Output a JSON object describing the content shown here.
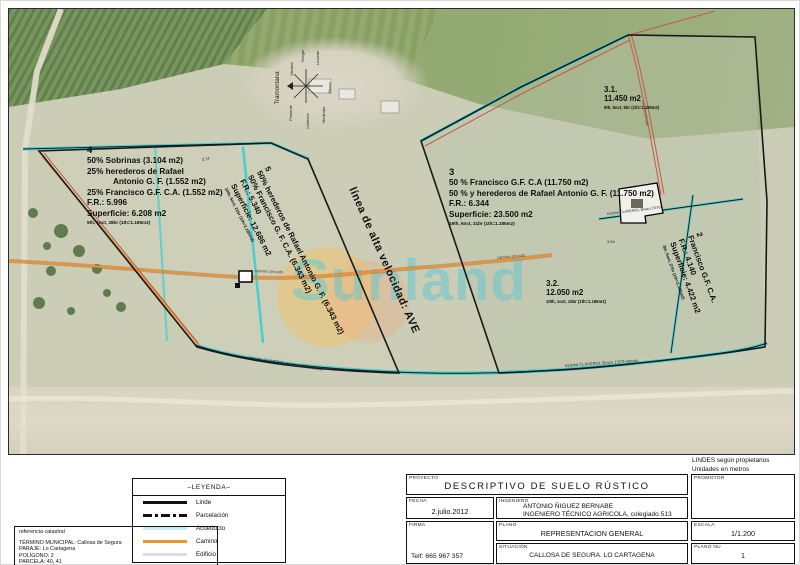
{
  "watermark": {
    "text": "Sunland"
  },
  "compass": {
    "labels": [
      "Tramontana",
      "Mestral",
      "Gregal",
      "Levante",
      "Siroco",
      "Mediodía",
      "Lebeche",
      "Poniente"
    ]
  },
  "map": {
    "parcels": {
      "p4": {
        "id": "4",
        "lines": [
          "50% Sobrinas (3.104 m2)",
          "25% herederos de Rafael",
          "Antonio G. F. (1.552 m2)",
          "25% Francisco G.F. C.A. (1.552 m2)",
          "F.R.: 5.996",
          "Superficie: 6.208 m2"
        ],
        "units": "5th, 1oct, 28br (1th=1.185m2)"
      },
      "p5": {
        "id": "5",
        "lines": [
          "50% herederos de Rafael Antonio G. F. (6.343 m2)",
          "50% Francisco G. F. C.A. (6.343 m2)",
          "F.R.: 5.340",
          "Superficie: 12.686 m2"
        ],
        "units": "10th, 5oct, 21br (1th=1.185m2)"
      },
      "p3": {
        "id": "3",
        "lines": [
          "50 % Francisco G.F. C.A (11.750 m2)",
          "50 % y herederos de Rafael Antonio G. F. (11.750 m2)",
          "F.R.: 6.344",
          "Superficie: 23.500 m2"
        ],
        "units": "19th, 6oct, 21br (1th=1.185m2)"
      },
      "p31": {
        "id": "3.1.",
        "area": "11.450 m2",
        "units": "9th, 5oct, 8br (1th=1.185m2)"
      },
      "p32": {
        "id": "3.2.",
        "area": "12.050 m2",
        "units": "10th, 1oct, 10br (1th=1.185m2)"
      },
      "p2": {
        "id": "2",
        "lines": [
          "Francisco G.F. C.A.",
          "F.R.: 4.140",
          "Superficie: 4.422 m2"
        ],
        "units": "3th, 5oct, 27br (1th=1.185m2)"
      }
    },
    "labels": {
      "ave": "línea de alta velocidad: AVE",
      "camino_privado": "camino privado",
      "azarbe_left": "Azarbe CLAVEROL  Medio  1'079 metros",
      "azarbe_right": "Azarbe CLAVEROL  Brazo  1'079 metros",
      "azarbe_diag": "Azarbe CLAVEROL Brazo 1'079",
      "dim_374": "3.74",
      "dim_354": "3.54"
    }
  },
  "notes": {
    "line1": "LINDES según propietarios",
    "line2": "Unidades en metros"
  },
  "legend": {
    "title": "–LEYENDA–",
    "items": [
      {
        "label": "Linde"
      },
      {
        "label": "Parcelación"
      },
      {
        "label": "Acueducto"
      },
      {
        "label": "Camino"
      },
      {
        "label": "Edificio"
      }
    ]
  },
  "reference": {
    "title": "referencia catastral",
    "lines": [
      "TÉRMINO MUNICIPAL: Callosa de Segura",
      "PARAJE: Lo Cartagena",
      "POLÍGONO: 2",
      "PARCELA: 40, 41"
    ]
  },
  "title_block": {
    "proyecto_label": "PROYECTO",
    "proyecto": "DESCRIPTIVO DE SUELO RÚSTICO",
    "promotor_label": "PROMOTOR",
    "fecha_label": "Fecha",
    "fecha": "2.julio.2012",
    "ingeniero_label": "INGENIERO",
    "ingeniero_1": "ANTONIO ÑIGUEZ BERNABE",
    "ingeniero_2": "INGENIERO TÉCNICO AGRICOLA, colegiado 513",
    "firma_label": "Firma",
    "telefono": "Telf: 665 967 357",
    "plano_label": "PLANO",
    "plano": "REPRESENTACION GENERAL",
    "escala_label": "ESCALA",
    "escala": "1/1.200",
    "situacion_label": "SITUACIÓN",
    "situacion": "CALLOSA DE SEGURA. LO CARTAGENA",
    "plano_num_label": "PLANO nu",
    "plano_num": "1"
  }
}
